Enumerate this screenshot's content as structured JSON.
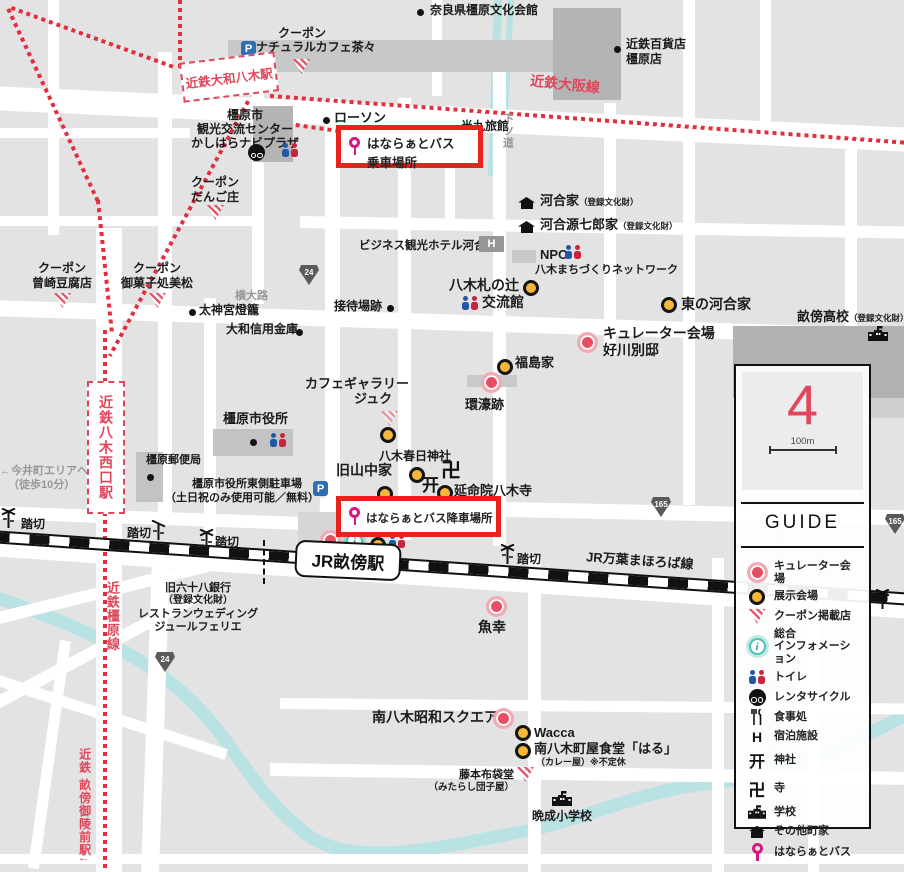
{
  "stations": {
    "yamato_yagi": "近鉄大和八木駅",
    "nishiguchi": "近鉄八木西口駅",
    "jr_unebi": "JR畝傍駅"
  },
  "rail": {
    "osaka_line": "近鉄大阪線",
    "kashihara_line": "近鉄橿原線",
    "manyo_line": "JR万葉まほろば線",
    "goryomae": "近鉄 畝傍御陵前駅↓"
  },
  "roads": {
    "r24": "24",
    "r165": "165",
    "yokooji": "横大路",
    "shimotsumichi": "下ツ道",
    "fumikiri": "踏切"
  },
  "highlights": {
    "board": {
      "line1": "はならぁとバス",
      "line2": "乗車場所"
    },
    "alight": "はならぁとバス降車場所"
  },
  "icons": {
    "parking": "P",
    "info": "i"
  },
  "pois": {
    "bunkakaikan": "奈良県橿原文化会館",
    "natural_cafe": {
      "l1": "クーポン",
      "l2": "ナチュラルカフェ茶々"
    },
    "dept": {
      "l1": "近鉄百貨店",
      "l2": "橿原店"
    },
    "navi": {
      "l1": "橿原市",
      "l2": "観光交流センター",
      "l3": "かしはらナビプラザ"
    },
    "lawson": "ローソン",
    "hanku": "半九旅館",
    "dango": {
      "l1": "クーポン",
      "l2": "だんご庄"
    },
    "kawai": {
      "name": "河合家",
      "reg": "（登録文化財）"
    },
    "kawai_gen": {
      "name": "河合源七郎家",
      "reg": "（登録文化財）"
    },
    "hotel_kawai": "ビジネス観光ホテル河合",
    "npo": {
      "l1": "NPO",
      "l2": "八木まちづくりネットワーク"
    },
    "higashi_kawai": "東の河合家",
    "unebi_hs": {
      "name": "畝傍高校",
      "reg": "（登録文化財）"
    },
    "yoshikawa": {
      "l1": "キュレーター会場",
      "l2": "好川別邸"
    },
    "sozaki": {
      "l1": "クーポン",
      "l2": "曾崎豆腐店"
    },
    "mimatsu": {
      "l1": "クーポン",
      "l2": "御菓子処美松"
    },
    "taijingu": "太神宮燈籠",
    "shinkin": "大和信用金庫",
    "settaiba": "接待場跡",
    "fudanotsuji": {
      "l1": "八木札の辻",
      "l2": "交流館"
    },
    "fukushima": "福島家",
    "kango": "環濠跡",
    "cafe_juku": {
      "l1": "カフェギャラリー",
      "l2": "ジュク"
    },
    "cityhall": "橿原市役所",
    "post": "橿原郵便局",
    "parking": {
      "l1": "橿原市役所東側駐車場",
      "l2": "（土日祝のみ使用可能／無料）"
    },
    "yamanaka": "旧山中家",
    "kasuga": "八木春日神社",
    "enmeiin": "延命院八木寺",
    "uokou": "魚幸",
    "bank68": {
      "l1": "旧六十八銀行",
      "l2": "（登録文化財）",
      "l3": "レストランウェディング",
      "l4": "ジュールフェリエ"
    },
    "imaicho": {
      "l1": "←今井町エリアへ",
      "l2": "（徒歩10分）"
    },
    "showa_square": "南八木昭和スクエア",
    "wacca": "Wacca",
    "haru": {
      "l1": "南八木町屋食堂「はる」",
      "l2": "（カレー屋）※不定休"
    },
    "fujimoto": {
      "l1": "藤本布袋堂",
      "l2": "（みたらし団子屋）"
    },
    "bansei": "晩成小学校"
  },
  "legend": {
    "compass": "4",
    "scale": "100m",
    "title": "GUIDE",
    "items": [
      {
        "label": "キュレーター会場"
      },
      {
        "label": "展示会場"
      },
      {
        "label": "クーポン掲載店"
      },
      {
        "label": "総合",
        "label2": "インフォメーション"
      },
      {
        "label": "トイレ"
      },
      {
        "label": "レンタサイクル"
      },
      {
        "label": "食事処"
      },
      {
        "label": "宿泊施設",
        "glyph": "H"
      },
      {
        "label": "神社",
        "glyph": "开"
      },
      {
        "label": "寺",
        "glyph": "卍"
      },
      {
        "label": "学校"
      },
      {
        "label": "その他町家"
      },
      {
        "label": "はならぁとバス"
      }
    ]
  }
}
